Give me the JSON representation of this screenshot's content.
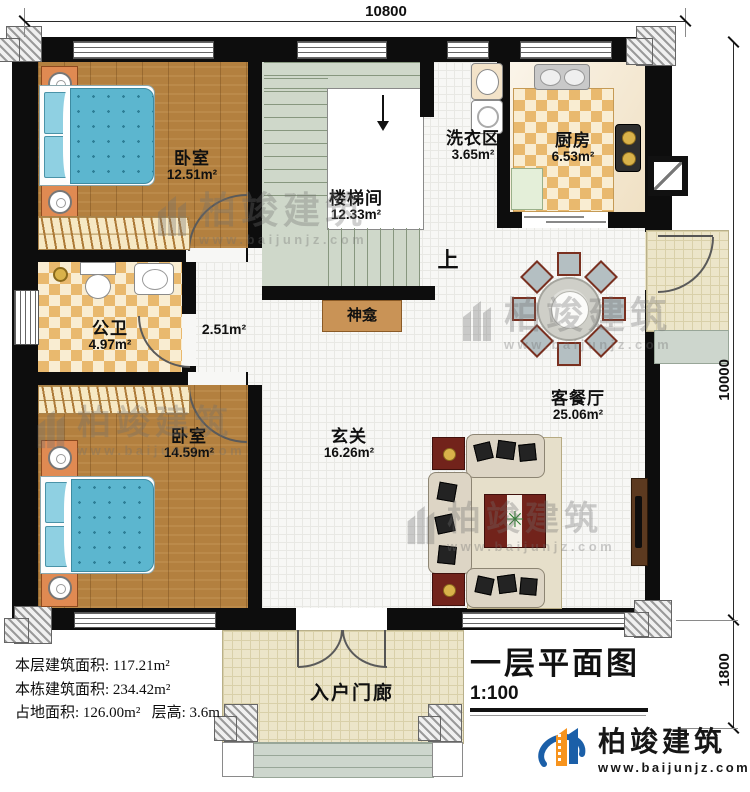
{
  "title_block": {
    "title": "一层平面图",
    "scale": "1:100"
  },
  "dimensions": {
    "top_width": "10800",
    "right_height": "10000",
    "porch_depth": "1800"
  },
  "rooms": {
    "bedroom_top": {
      "name": "卧室",
      "area": "12.51m²"
    },
    "stairwell": {
      "name": "楼梯间",
      "area": "12.33m²",
      "up_label": "上"
    },
    "laundry": {
      "name": "洗衣区",
      "area": "3.65m²"
    },
    "kitchen": {
      "name": "厨房",
      "area": "6.53m²"
    },
    "bathroom": {
      "name": "公卫",
      "area": "4.97m²"
    },
    "hallway": {
      "area": "2.51m²"
    },
    "shrine": {
      "name": "神龛"
    },
    "bedroom_bottom": {
      "name": "卧室",
      "area": "14.59m²"
    },
    "foyer": {
      "name": "玄关",
      "area": "16.26m²"
    },
    "living_dining": {
      "name": "客餐厅",
      "area": "25.06m²"
    },
    "entry_porch": {
      "name": "入户门廊"
    }
  },
  "stats": {
    "floor_area": "本层建筑面积: 117.21m²",
    "total_area": "本栋建筑面积: 234.42m²",
    "footprint": "占地面积: 126.00m²",
    "story_height": "层高: 3.6m"
  },
  "brand": {
    "name": "柏竣建筑",
    "url": "www.baijunjz.com"
  },
  "colors": {
    "wall": "#0d0d0d",
    "wood_floor": "#b3803f",
    "stair_floor": "#cfd8ca",
    "checker_tan": "#e9b96e",
    "tile": "#f7f7f5",
    "porch": "#ece5c9",
    "bed_blue": "#5cb6cf",
    "logo_blue": "#1b5fa8",
    "logo_orange": "#f7941e",
    "accent_red": "#72231b"
  }
}
